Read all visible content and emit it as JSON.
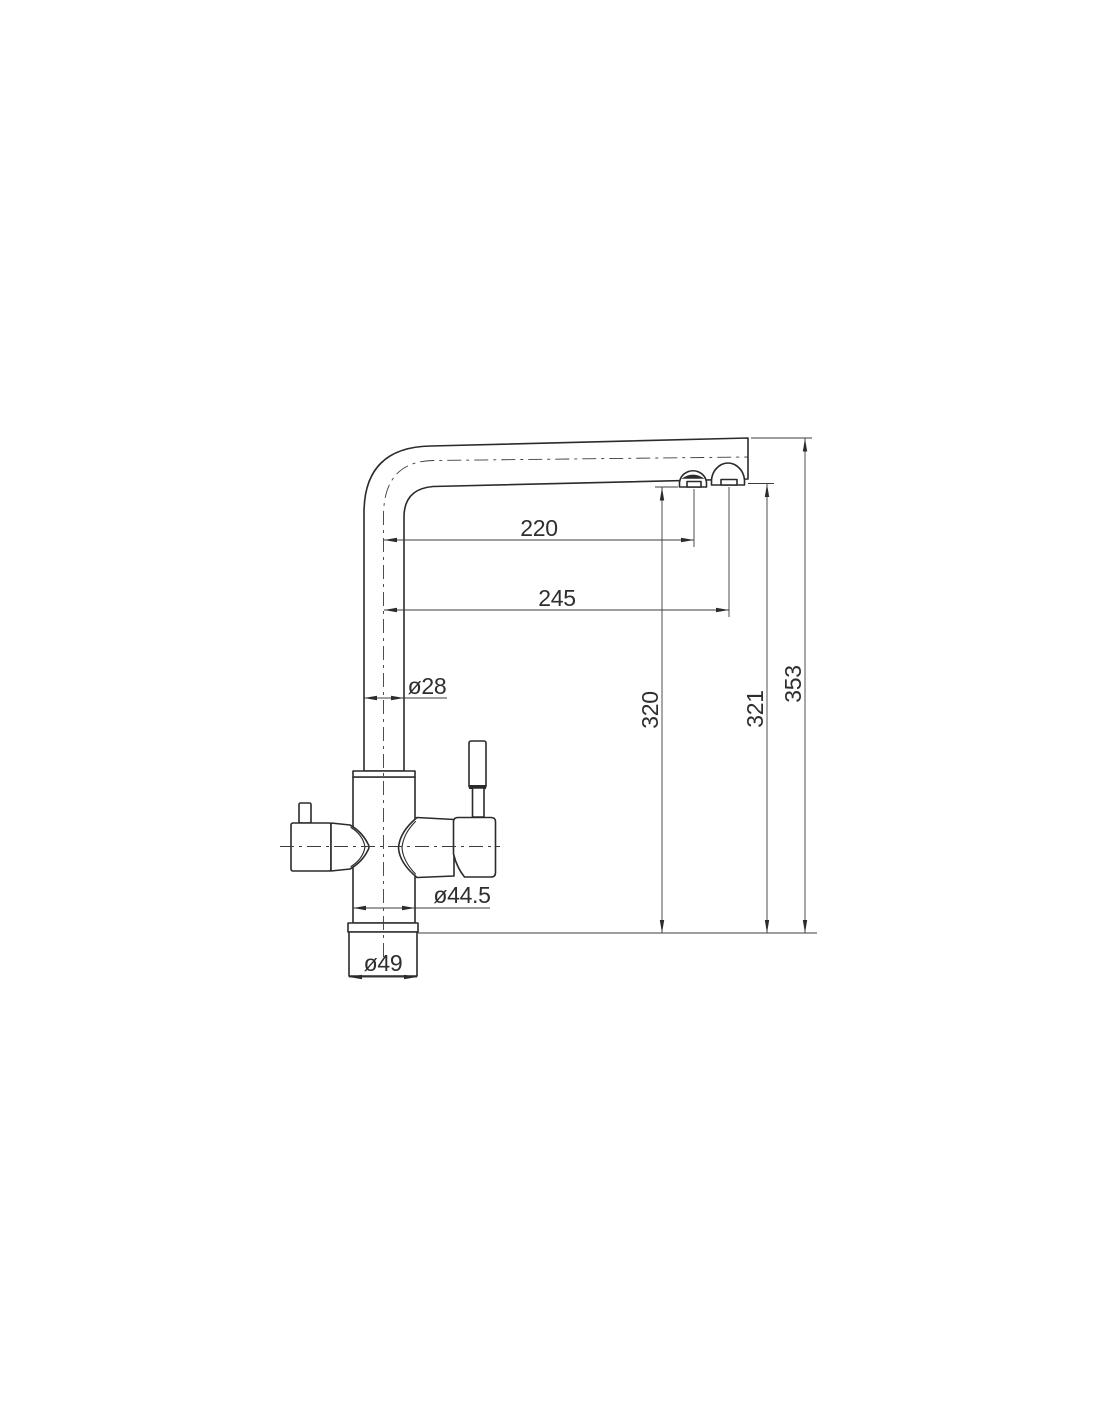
{
  "drawing": {
    "dim_labels": {
      "spout_reach_1": "220",
      "spout_reach_2": "245",
      "spout_pipe_diameter": "ø28",
      "outlet_height_1": "320",
      "outlet_height_2": "321",
      "overall_height": "353",
      "body_diameter": "ø44.5",
      "base_diameter": "ø49"
    },
    "colors": {
      "object_line": "#2b2b2b",
      "dimension_line": "#3c3c3c",
      "text": "#2e2e2e",
      "background": "#ffffff"
    }
  }
}
